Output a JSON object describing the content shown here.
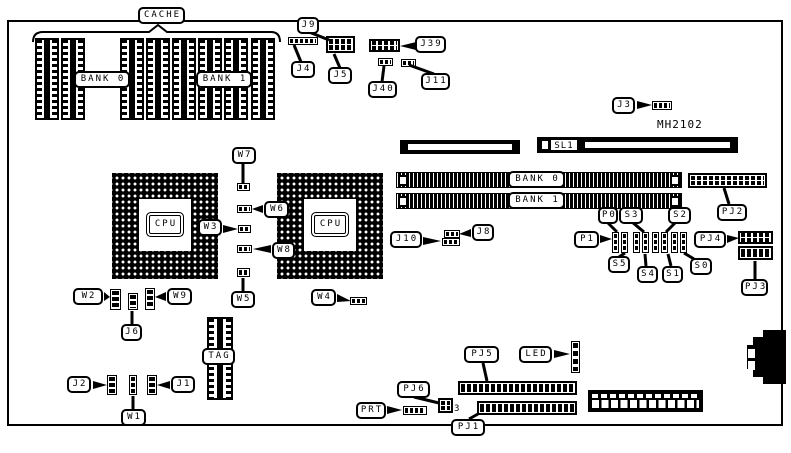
{
  "colors": {
    "ink": "#000000",
    "paper": "#ffffff"
  },
  "board": {
    "model": "MH2102"
  },
  "cache": {
    "title": "CACHE",
    "bank0": "BANK 0",
    "bank1": "BANK 1",
    "tag": "TAG"
  },
  "cpu": {
    "left": "CPU",
    "right": "CPU"
  },
  "memory": {
    "bank0": "BANK 0",
    "bank1": "BANK 1"
  },
  "slots": {
    "sl1": "SL1"
  },
  "jumpers": {
    "j1": "J1",
    "j2": "J2",
    "j3": "J3",
    "j4": "J4",
    "j5": "J5",
    "j6": "J6",
    "j8": "J8",
    "j9": "J9",
    "j10": "J10",
    "j11": "J11",
    "j39": "J39",
    "j40": "J40"
  },
  "straps": {
    "w1": "W1",
    "w2": "W2",
    "w3": "W3",
    "w4": "W4",
    "w5": "W5",
    "w6": "W6",
    "w7": "W7",
    "w8": "W8",
    "w9": "W9"
  },
  "switches": {
    "p0": "P0",
    "p1": "P1",
    "s0": "S0",
    "s1": "S1",
    "s2": "S2",
    "s3": "S3",
    "s4": "S4",
    "s5": "S5"
  },
  "connectors": {
    "pj1": "PJ1",
    "pj2": "PJ2",
    "pj3": "PJ3",
    "pj4": "PJ4",
    "pj5": "PJ5",
    "pj6": "PJ6",
    "pj6_pin_count": "3",
    "prt": "PRT",
    "led": "LED"
  }
}
